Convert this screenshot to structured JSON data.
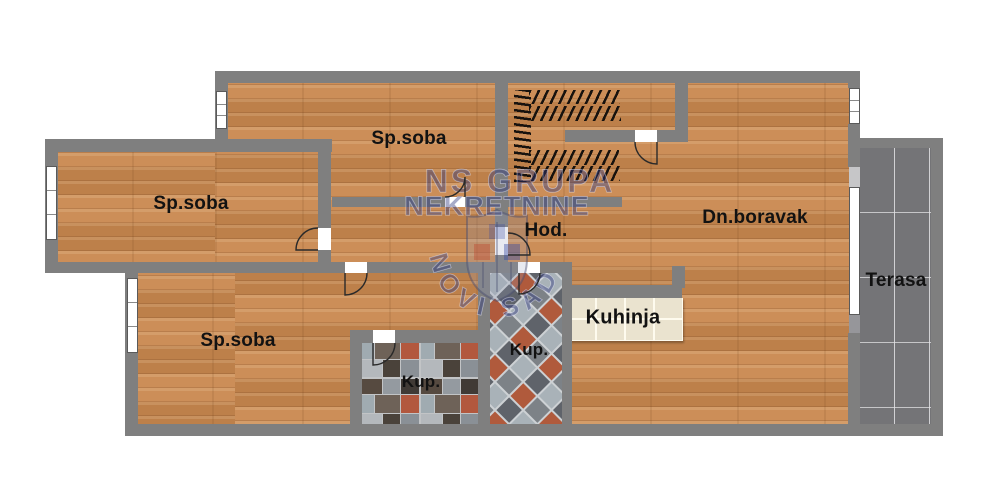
{
  "labels": {
    "bedroom_top": "Sp.soba",
    "bedroom_left": "Sp.soba",
    "bedroom_bottom": "Sp.soba",
    "living_room": "Dn.boravak",
    "hallway": "Hod.",
    "kitchen": "Kuhinja",
    "bathroom_center": "Kup.",
    "bathroom_bottom": "Kup.",
    "terrace": "Terasa"
  },
  "watermark": {
    "line1": "NS GRUPA",
    "line2": "NEKRETNINE",
    "arc_text": "NOVI SAD"
  },
  "colors": {
    "wall": "#7f7f7f",
    "wood": "#c9884f",
    "terrace_tile": "#747477",
    "counter_tile": "#eae3cf",
    "watermark_blue": "#2d3782"
  }
}
